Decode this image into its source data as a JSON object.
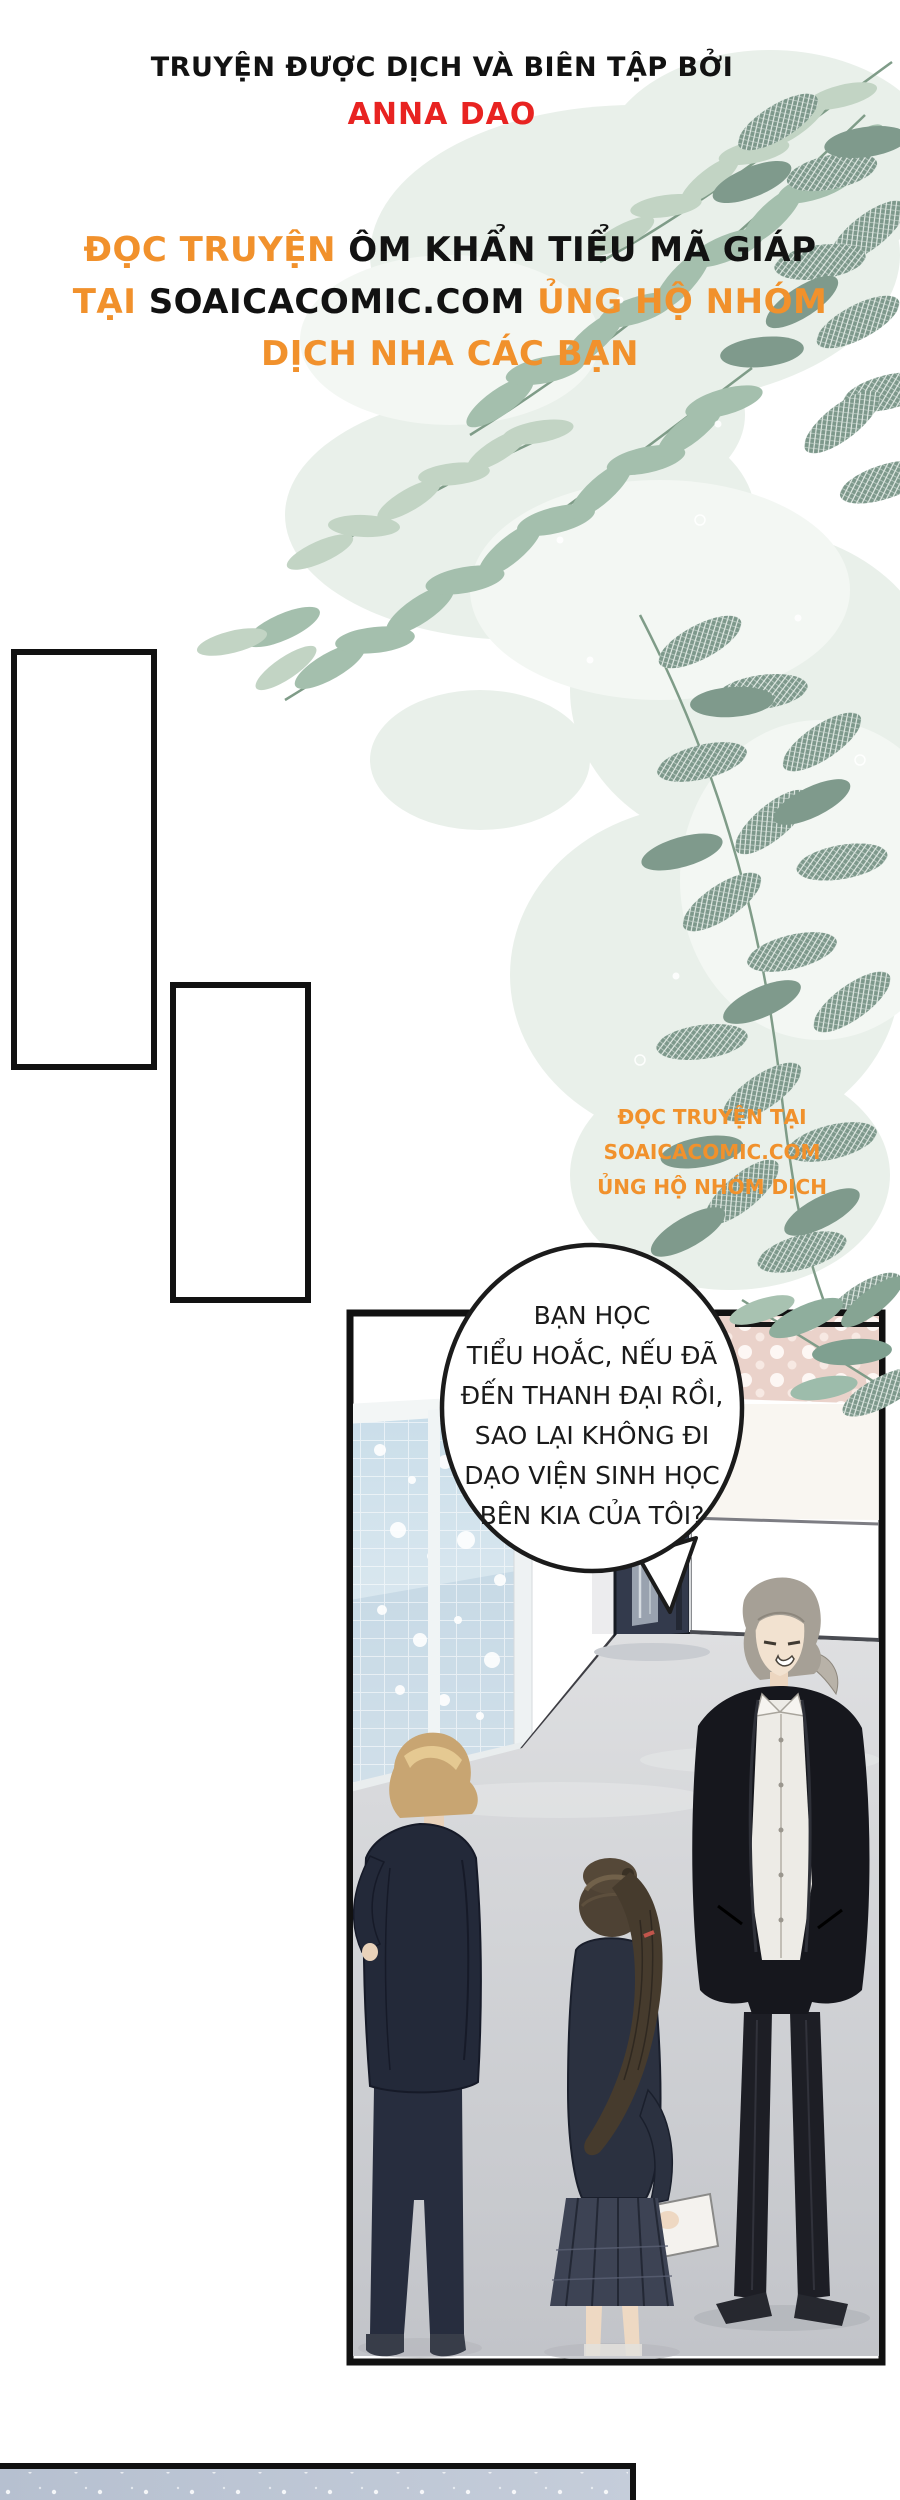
{
  "page_type": "translated comic page",
  "header": {
    "credit_line": "TRUYỆN ĐƯỢC DỊCH VÀ BIÊN TẬP BỞI",
    "author": "ANNA DAO"
  },
  "promo": {
    "l1_orange": "ĐỌC TRUYỆN",
    "l1_black": "ÔM KHẨN TIỂU MÃ GIÁP",
    "l2_orange_a": "TẠI",
    "l2_black": "SOAICACOMIC.COM",
    "l2_orange_b": "ỦNG HỘ",
    "l3_orange": "NHÓM DỊCH NHA CÁC BẠN"
  },
  "watermark": {
    "line1": "ĐỌC TRUYỆN TẠI",
    "line2": "SOAICACOMIC.COM",
    "line3": "ỦNG HỘ NHÓM DỊCH"
  },
  "bubble": {
    "lines": [
      "BẠN HỌC",
      "TIỂU HOẮC, NẾU ĐÃ",
      "ĐẾN THANH ĐẠI RỒI,",
      "SAO LẠI KHÔNG ĐI",
      "DẠO VIỆN SINH HỌC",
      "BÊN KIA CỦA TÔI?"
    ]
  },
  "colors": {
    "orange": "#f1912c",
    "red": "#e82321",
    "ink": "#121212",
    "leaf_light": "#c2d4c4",
    "leaf_mid": "#a4bfad",
    "leaf_dark": "#7f9a8c",
    "polka_dark": "#56525e",
    "polka_pink": "#ead2ca",
    "glass_blue": "#c9dde9",
    "floor_gray": "#c6c8cc",
    "bottom_panel_blue": "#b9c3d2"
  }
}
